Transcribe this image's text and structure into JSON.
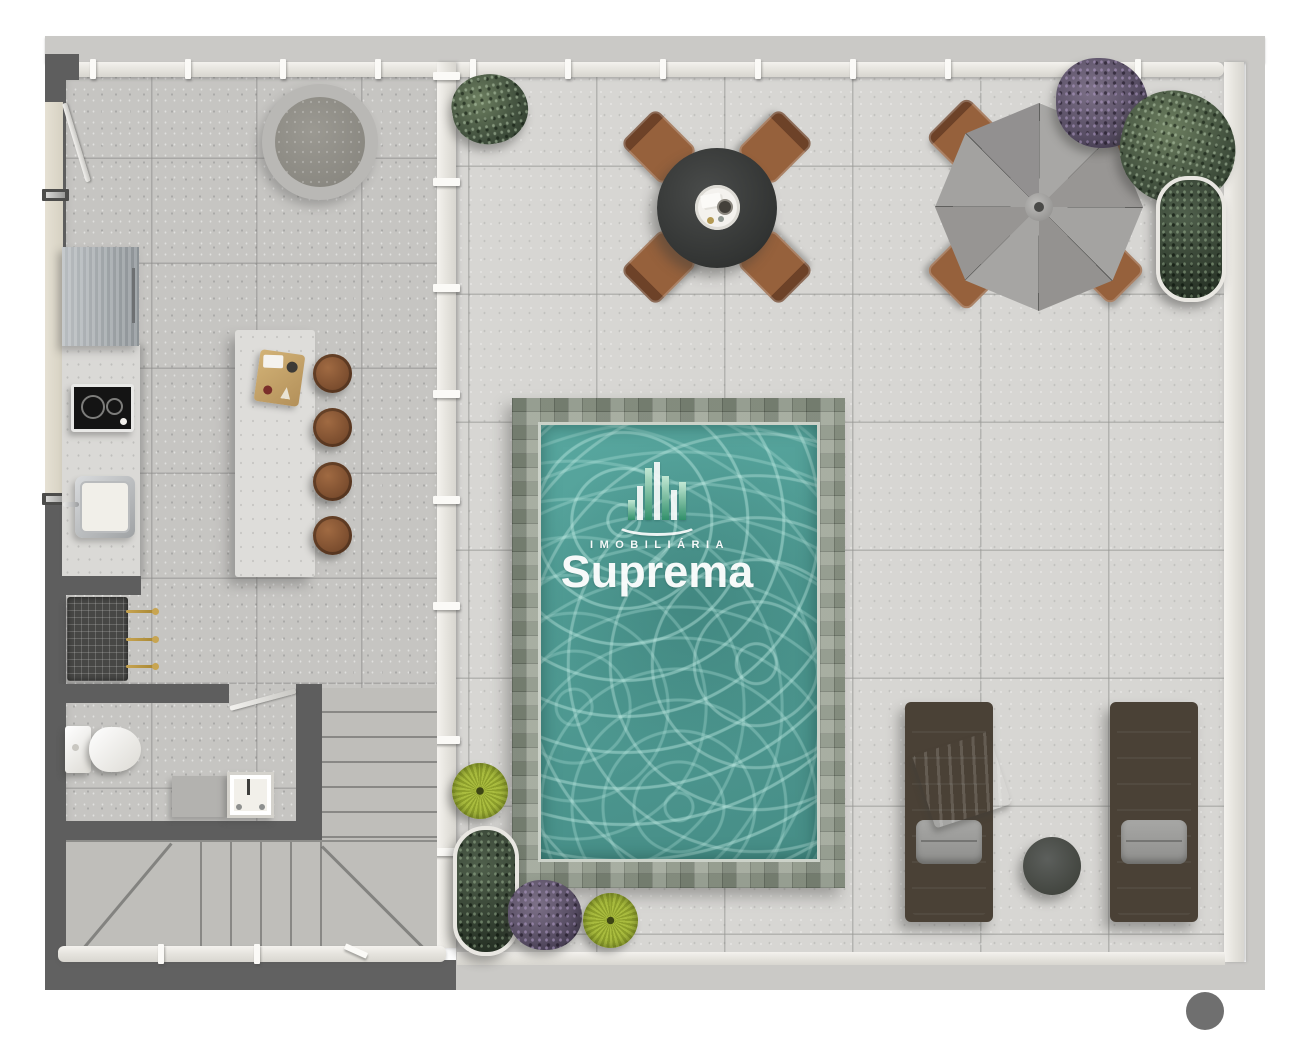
{
  "watermark": {
    "line1": "IMOBILIÁRIA",
    "line2": "Suprema"
  },
  "colors": {
    "band_concrete": "#cac9c6",
    "wall_dark": "#5e5e5e",
    "tile_left": "#c6c5c2",
    "tile_right": "#d7d6d3",
    "pool_border": "#99a193",
    "pool_water": "#4f9d95",
    "umbrella_gray": "#a09f9d",
    "furniture_brown": "#8a5a39",
    "table_dark": "#3e403f",
    "lounger_cushion": "#d9d5cb",
    "pillow_gray": "#9a9a98",
    "towel_blue": "#7b8591",
    "plant_green": "#4c5b49",
    "plant_lime": "#9aac34",
    "plant_purple": "#675d73",
    "logo_green": "#2f8f68",
    "dot_gray": "#6f6f6f"
  }
}
